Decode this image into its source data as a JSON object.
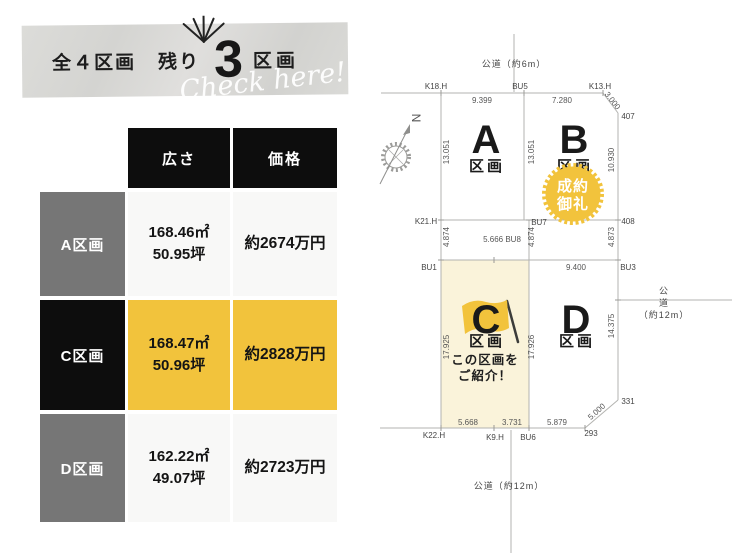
{
  "banner": {
    "prefix": "全４区画",
    "remaining_label": "残り",
    "remaining_count": "3",
    "unit": "区画",
    "script": "Check here!"
  },
  "table": {
    "headers": {
      "size": "広さ",
      "price": "価格"
    },
    "rows": [
      {
        "label": "A区画",
        "area_m2": "168.46㎡",
        "area_tsubo": "50.95坪",
        "price": "約2674万円"
      },
      {
        "label": "C区画",
        "area_m2": "168.47㎡",
        "area_tsubo": "50.96坪",
        "price": "約2828万円"
      },
      {
        "label": "D区画",
        "area_m2": "162.22㎡",
        "area_tsubo": "49.07坪",
        "price": "約2723万円"
      }
    ]
  },
  "map": {
    "roads": {
      "top": "公道（約6m）",
      "bottom": "公道（約12m）",
      "right_1": "公",
      "right_2": "道",
      "right_3": "（約12m）"
    },
    "compass_n": "N",
    "plots": {
      "a": {
        "letter": "A",
        "kukaku": "区画"
      },
      "b": {
        "letter": "B",
        "kukaku": "区画",
        "badge_line1": "成約",
        "badge_line2": "御礼"
      },
      "c": {
        "letter": "C",
        "kukaku": "区画",
        "promo_line1": "この区画を",
        "promo_line2": "ご紹介！"
      },
      "d": {
        "letter": "D",
        "kukaku": "区画"
      }
    },
    "dims": {
      "top_a": "9.399",
      "top_b": "7.280",
      "diag_tr": "3.000",
      "left_a": "13.051",
      "mid_ab": "13.051",
      "right_b": "10.930",
      "left_strip": "4.874",
      "mid_strip": "4.874",
      "right_strip": "4.873",
      "strip_w": "5.666 BU8",
      "top_d": "9.400",
      "left_c": "17.925",
      "mid_cd": "17.926",
      "right_d": "14.375",
      "bot_c1": "5.668",
      "bot_c2": "3.731",
      "bot_d": "5.879",
      "diag_br": "5.000"
    },
    "points": {
      "k18h": "K18.H",
      "bu5": "BU5",
      "k13h": "K13.H",
      "p407": "407",
      "k21h": "K21.H",
      "bu7": "BU7",
      "p408": "408",
      "bu1": "BU1",
      "bu3": "BU3",
      "k22h": "K22.H",
      "k9h": "K9.H",
      "bu6": "BU6",
      "p293": "293",
      "p331": "331"
    }
  },
  "colors": {
    "accent_yellow": "#f2c33c",
    "pale_yellow": "#faf3da",
    "label_gray": "#767676",
    "header_black": "#0d0d0d",
    "banner_gray": "#d8d8d5"
  }
}
